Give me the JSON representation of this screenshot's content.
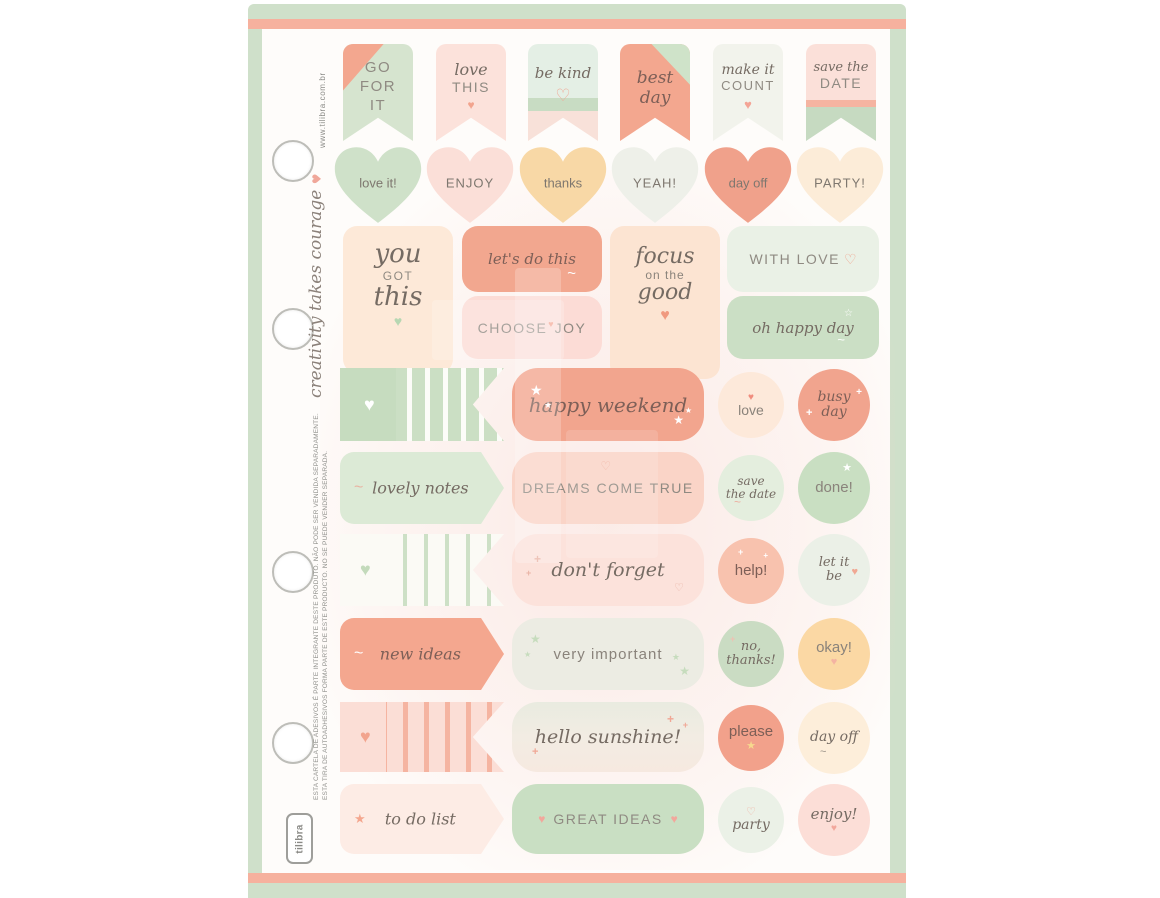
{
  "sheet": {
    "frame_color": "#cfe0ca",
    "stripe_color": "#f6b19e",
    "page_color": "#fefcfa"
  },
  "side": {
    "website": "www.tilibra.com.br",
    "slogan": "creativity takes courage",
    "slogan_heart": "♥",
    "disclaimer_pt": "ESTA CARTELA DE ADESIVOS É PARTE INTEGRANTE DESTE PRODUTO. NÃO PODE SER VENDIDA SEPARADAMENTE.",
    "disclaimer_es": "ESTA TIRA DE AUTOADHESIVOS FORMA PARTE DE ESTE PRODUCTO. NO SE PUEDE VENDER SEPARADA.",
    "brand": "tilibra"
  },
  "icons": {
    "heart": "♥",
    "heart_outline": "♡",
    "star": "★",
    "star_outline": "☆",
    "sparkle": "+",
    "swirl": "~"
  },
  "banners": [
    {
      "line1": "GO",
      "line2": "FOR",
      "line3": "IT",
      "bg": "#d6e4cf",
      "accent": "#f3a78f"
    },
    {
      "script": "love",
      "caps": "THIS",
      "bg": "#fce2db",
      "heart_color": "#f2a48e"
    },
    {
      "script": "be kind",
      "bg_top": "#e4efe5",
      "band": "#c8dcc3",
      "bg_bottom": "#f8e1d9",
      "heart_color": "#f0a896"
    },
    {
      "script_line1": "best",
      "script_line2": "day",
      "bg": "#f3a78f",
      "accent": "#cfe3c9"
    },
    {
      "script": "make it",
      "caps": "COUNT",
      "bg": "#f2f3ec",
      "heart_color": "#f4a496"
    },
    {
      "script": "save the",
      "caps": "DATE",
      "bg_top": "#fbe0d9",
      "band": "#f5b4a1",
      "bg_bottom": "#c6dac1"
    }
  ],
  "hearts": [
    {
      "label": "love it!",
      "color": "#cfe1c9"
    },
    {
      "label": "ENJOY",
      "color": "#fbdfd8"
    },
    {
      "label": "thanks",
      "color": "#f8d8a6"
    },
    {
      "label": "YEAH!",
      "color": "#eef0e9"
    },
    {
      "label": "day off",
      "color": "#f0a18b"
    },
    {
      "label": "PARTY!",
      "color": "#fcecd8"
    }
  ],
  "quotes": {
    "you_got_this": {
      "line1": "you",
      "line2": "GOT",
      "line3": "this",
      "bg": "#fde9d8",
      "heart_color": "#b7d7b2"
    },
    "lets_do_this": {
      "label": "let's do this",
      "bg": "#f2a78f"
    },
    "choose_joy": {
      "word1": "CHOOSE",
      "word2": "JOY",
      "bg": "#fcdcd6",
      "heart_color": "#f29d88"
    },
    "focus_good": {
      "line1": "focus",
      "line2": "on the",
      "line3": "good",
      "bg": "#fce4d2",
      "heart_color": "#f0997f"
    },
    "with_love": {
      "label": "WITH LOVE",
      "bg": "#eaf1e6",
      "heart_color": "#f0a28c"
    },
    "oh_happy_day": {
      "label": "oh happy day",
      "bg": "#cbdfc5"
    }
  },
  "rows": [
    {
      "pill": {
        "label": "happy weekend",
        "bg": "#f2a58e"
      },
      "circle_a": {
        "label": "love",
        "bg": "#fde9da",
        "heart_color": "#f08d7e"
      },
      "circle_b": {
        "line1": "busy",
        "line2": "day",
        "bg": "#f1a48e"
      }
    },
    {
      "tag": {
        "label": "lovely notes",
        "bg": "#dcead6"
      },
      "pill": {
        "label": "DREAMS COME TRUE",
        "bg": "#fad4c7",
        "heart_color": "#f0b3a2"
      },
      "circle_a": {
        "line1": "save",
        "line2": "the date",
        "bg": "#e4eede"
      },
      "circle_b": {
        "label": "done!",
        "bg": "#c9dfc2"
      }
    },
    {
      "pill": {
        "label": "don't forget",
        "bg": "#fce2db"
      },
      "circle_a": {
        "label": "help!",
        "bg": "#f8c2ae"
      },
      "circle_b": {
        "line1": "let it",
        "line2": "be",
        "bg": "#ebf0e7",
        "heart_color": "#f0a893"
      }
    },
    {
      "tag": {
        "label": "new ideas",
        "bg": "#f4a78f"
      },
      "pill": {
        "label": "very important",
        "bg": "#ecece3"
      },
      "circle_a": {
        "line1": "no,",
        "line2": "thanks!",
        "bg": "#cadcc3"
      },
      "circle_b": {
        "label": "okay!",
        "bg": "#fbd8a4",
        "heart_color": "#f4b3a2"
      }
    },
    {
      "pill": {
        "label": "hello sunshine!",
        "bg": "linear-gradient(180deg,#e9ebe0,#f2ece3,#f6e9e0)"
      },
      "circle_a": {
        "label": "please",
        "bg": "#f2a18b",
        "star_color": "#f7d98e"
      },
      "circle_b": {
        "label": "day off",
        "bg": "#fdeeda"
      }
    },
    {
      "tag": {
        "label": "to do list",
        "bg": "#fdece5",
        "star_color": "#f4a78f"
      },
      "pill": {
        "label": "GREAT IDEAS",
        "bg": "#c9dfc3",
        "heart_color": "#f2a79c"
      },
      "circle_a": {
        "label": "party",
        "bg": "#ebf1e7",
        "heart_color": "#f0b0a0"
      },
      "circle_b": {
        "label": "enjoy!",
        "bg": "#fcded7",
        "heart_color": "#f2a79c"
      }
    }
  ]
}
